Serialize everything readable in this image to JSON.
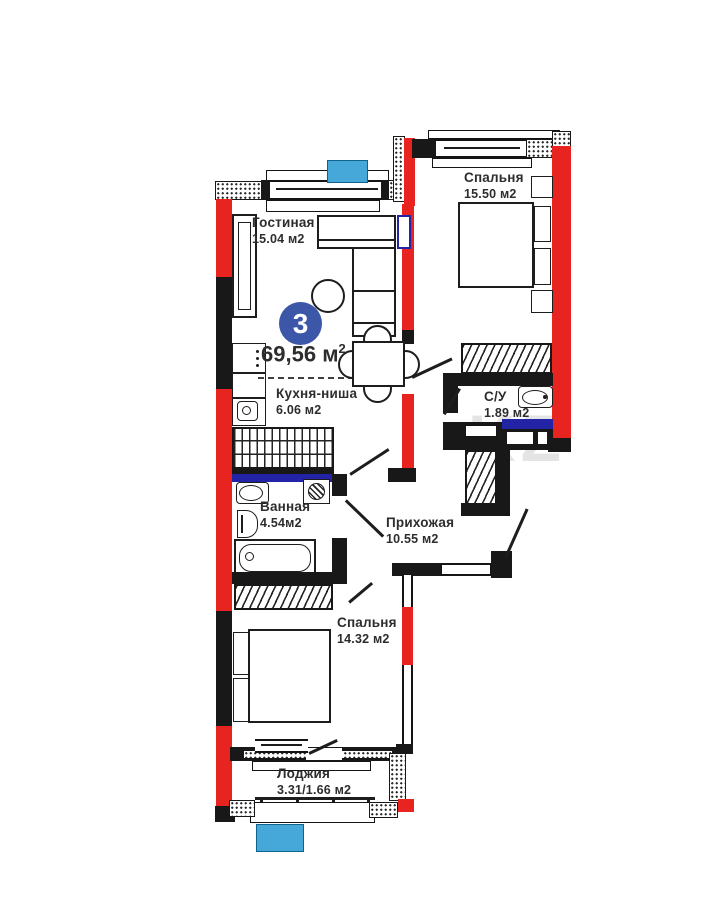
{
  "plan": {
    "badge": "3",
    "total": {
      "value": "69,56",
      "unit": "м",
      "sup": "2"
    },
    "watermark": "KZ",
    "rooms": [
      {
        "name": "Гостиная",
        "area": "15.04 м2"
      },
      {
        "name": "Спальня",
        "area": "15.50 м2"
      },
      {
        "name": "Кухня-ниша",
        "area": "6.06 м2"
      },
      {
        "name": "С/У",
        "area": "1.89 м2"
      },
      {
        "name": "Ванная",
        "area": "4.54м2"
      },
      {
        "name": "Прихожая",
        "area": "10.55 м2"
      },
      {
        "name": "Спальня",
        "area": "14.32 м2"
      },
      {
        "name": "Лоджия",
        "area": "3.31/1.66 м2"
      }
    ],
    "colors": {
      "wall_black": "#181818",
      "wall_red": "#e82420",
      "marker_blue": "#45a8d8",
      "badge_blue": "#3c57a8",
      "partition_navy": "#2323a6"
    }
  }
}
